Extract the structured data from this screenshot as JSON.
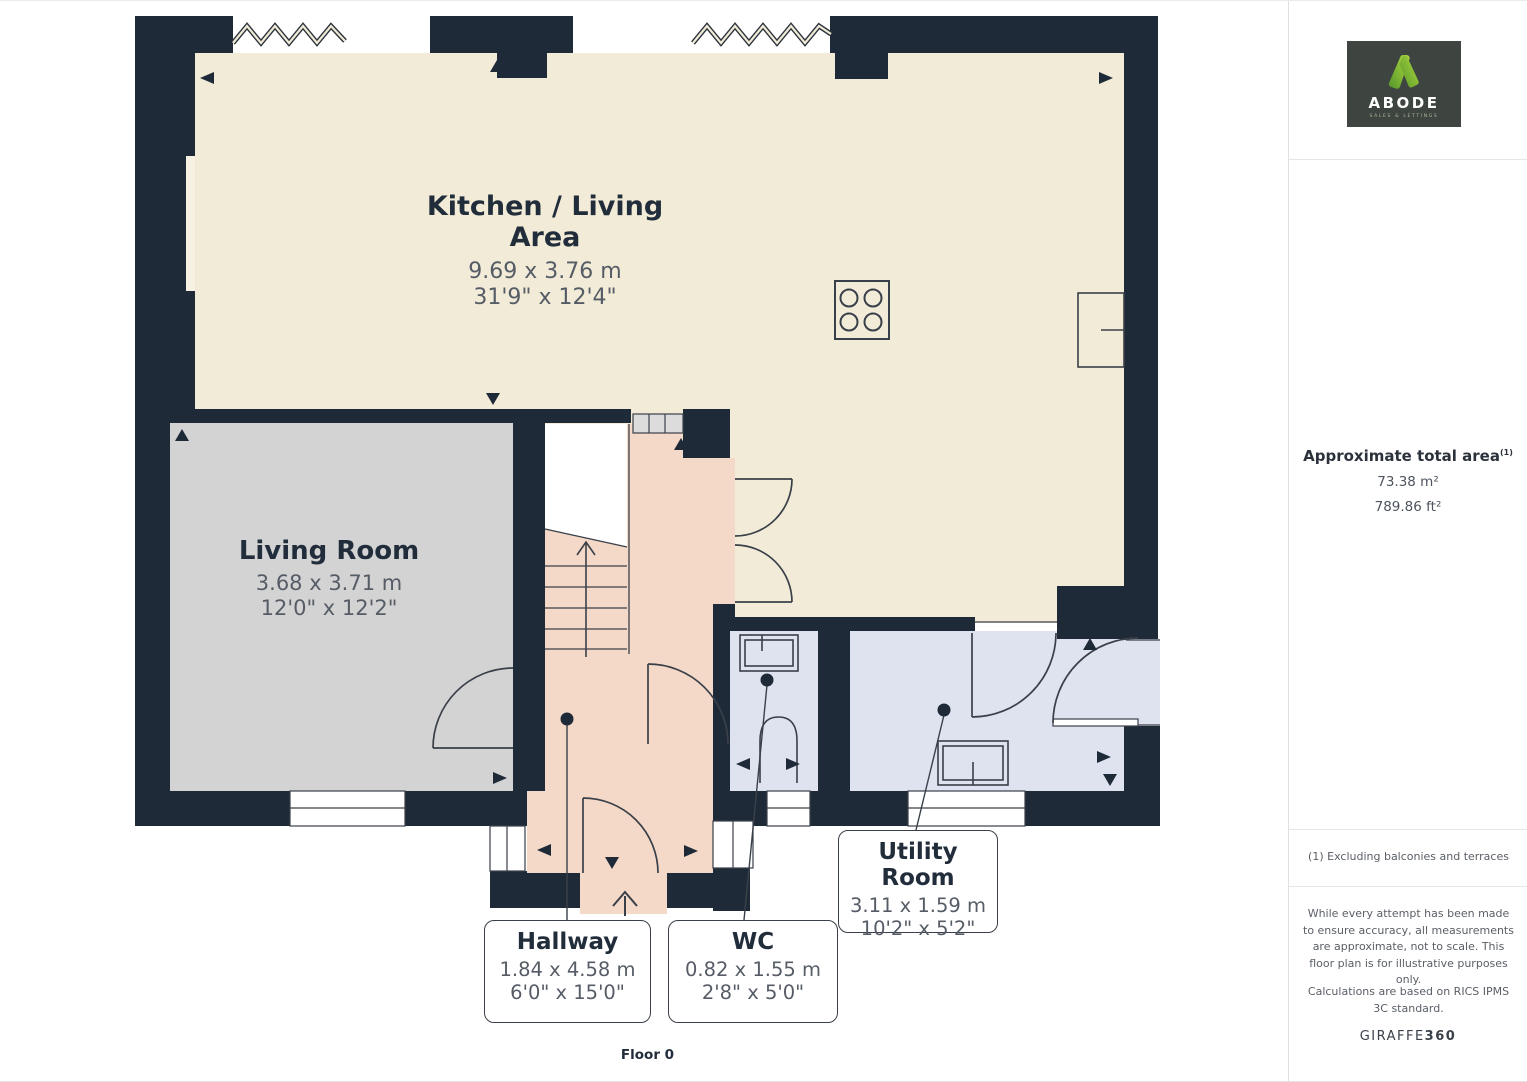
{
  "page": {
    "floor_label": "Floor 0"
  },
  "rooms": [
    {
      "name": "Kitchen / Living Area",
      "dim_m": "9.69 x 3.76 m",
      "dim_ft": "31'9\" x 12'4\""
    },
    {
      "name": "Living Room",
      "dim_m": "3.68 x 3.71 m",
      "dim_ft": "12'0\" x 12'2\""
    }
  ],
  "callouts": [
    {
      "name": "Hallway",
      "dim_m": "1.84 x 4.58 m",
      "dim_ft": "6'0\" x 15'0\""
    },
    {
      "name": "WC",
      "dim_m": "0.82 x 1.55 m",
      "dim_ft": "2'8\" x 5'0\""
    },
    {
      "name": "Utility Room",
      "dim_m": "3.11 x 1.59 m",
      "dim_ft": "10'2\" x 5'2\""
    }
  ],
  "sidebar": {
    "logo": {
      "brand": "ABODE",
      "tagline": "SALES & LETTINGS"
    },
    "area_title": "Approximate total area",
    "area_footnote_marker": "(1)",
    "area_m2": "73.38 m²",
    "area_ft2": "789.86 ft²",
    "footnote": "(1) Excluding balconies and terraces",
    "disclaimer": "While every attempt has been made to ensure accuracy, all measurements are approximate, not to scale. This floor plan is for illustrative purposes only.",
    "standard": "Calculations are based on RICS IPMS 3C standard.",
    "brand_footer_left": "GIRAFFE",
    "brand_footer_right": "360"
  },
  "colors": {
    "wall": "#1f2a38",
    "kitchen_fill": "#f1ebd7",
    "living_fill": "#d3d3d3",
    "hallway_fill": "#f4d9c8",
    "wet_room_fill": "#dfe3ef",
    "logo_green": "#8dc63f",
    "logo_background": "#3e4540"
  }
}
